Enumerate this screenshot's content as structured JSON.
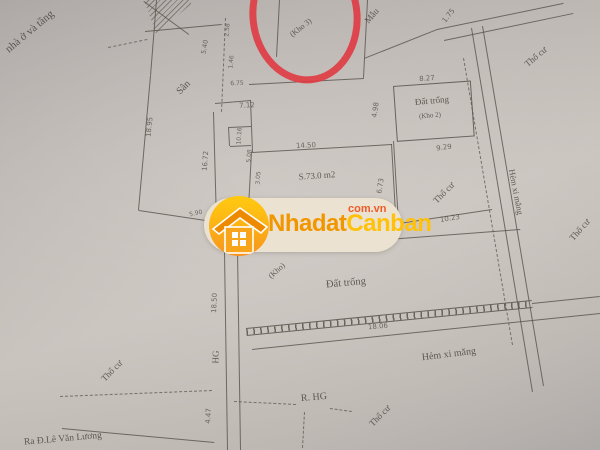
{
  "colors": {
    "ink": "#57514b",
    "paper": "#bcb6b1",
    "highlight": "#e03a42",
    "logo_yellow": "#ffc10a",
    "logo_orange": "#f29600",
    "logo_red": "#ef5a28",
    "logo_bg": "#ece2d1"
  },
  "logo": {
    "brand_part1": "Nhadat",
    "brand_part2": "Canban",
    "domain_suffix": "com.vn"
  },
  "labels": [
    {
      "name": "note-top-left",
      "text": "nhà ở và tầng",
      "x": 30,
      "y": 32,
      "rot": -40,
      "size": 11,
      "font": "serif"
    },
    {
      "name": "san-label",
      "text": "Sân",
      "x": 184,
      "y": 88,
      "rot": -45,
      "size": 10,
      "font": "serif"
    },
    {
      "name": "mau-label",
      "text": "Mẫu",
      "x": 372,
      "y": 16,
      "rot": -50,
      "size": 9,
      "font": "serif"
    },
    {
      "name": "kho3-label",
      "text": "(Kho 3)",
      "x": 301,
      "y": 28,
      "rot": -38,
      "size": 8,
      "font": "serif"
    },
    {
      "name": "thocu-top-right",
      "text": "Thổ cư",
      "x": 536,
      "y": 57,
      "rot": -40,
      "size": 9,
      "font": "serif"
    },
    {
      "name": "dattrong-kho2-label",
      "text": "Đất trống",
      "x": 432,
      "y": 101,
      "rot": -5,
      "size": 9,
      "font": "serif"
    },
    {
      "name": "kho2-label",
      "text": "(Kho 2)",
      "x": 430,
      "y": 116,
      "rot": -5,
      "size": 7,
      "font": "serif"
    },
    {
      "name": "area-label",
      "text": "S.73.0 m2",
      "x": 317,
      "y": 176,
      "rot": -4,
      "size": 9,
      "font": "serif"
    },
    {
      "name": "thocu-middle",
      "text": "Thổ cư",
      "x": 444,
      "y": 193,
      "rot": -45,
      "size": 9,
      "font": "serif"
    },
    {
      "name": "hem-xi-mang-right",
      "text": "Hẻm xi măng",
      "x": 516,
      "y": 192,
      "rot": 79,
      "size": 8.5,
      "font": "serif"
    },
    {
      "name": "thocu-far-right",
      "text": "Thổ cư",
      "x": 580,
      "y": 230,
      "rot": -48,
      "size": 9,
      "font": "serif"
    },
    {
      "name": "dattrong-bottom-label",
      "text": "Đất trống",
      "x": 346,
      "y": 284,
      "rot": -5,
      "size": 10.5,
      "font": "serif"
    },
    {
      "name": "kho-bottom-label",
      "text": "(Kho)",
      "x": 277,
      "y": 271,
      "rot": -42,
      "size": 8,
      "font": "serif"
    },
    {
      "name": "thocu-bottom-left",
      "text": "Thổ cư",
      "x": 112,
      "y": 371,
      "rot": -45,
      "size": 9,
      "font": "serif"
    },
    {
      "name": "thocu-bottom-mid",
      "text": "Thổ cư",
      "x": 380,
      "y": 416,
      "rot": -45,
      "size": 9,
      "font": "serif"
    },
    {
      "name": "hem-xi-mang-bottom",
      "text": "Hẻm xi măng",
      "x": 449,
      "y": 355,
      "rot": -7,
      "size": 10,
      "font": "serif"
    },
    {
      "name": "r-hg-label",
      "text": "R. HG",
      "x": 314,
      "y": 398,
      "rot": -5,
      "size": 10,
      "font": "serif"
    },
    {
      "name": "hg-label",
      "text": "HG",
      "x": 216,
      "y": 357,
      "rot": -88,
      "size": 9,
      "font": "serif"
    },
    {
      "name": "ra-le-van-luong-label",
      "text": "Ra Đ.Lê Văn Lương",
      "x": 63,
      "y": 440,
      "rot": -5,
      "size": 9.5,
      "font": "serif"
    },
    {
      "name": "dim-18-95",
      "text": "18.95",
      "x": 150,
      "y": 127,
      "rot": -84,
      "size": 7,
      "font": "sans"
    },
    {
      "name": "dim-16-72",
      "text": "16.72",
      "x": 206,
      "y": 161,
      "rot": -86,
      "size": 7,
      "font": "sans"
    },
    {
      "name": "dim-7-12",
      "text": "7.12",
      "x": 247,
      "y": 106,
      "rot": -3,
      "size": 7,
      "font": "sans"
    },
    {
      "name": "dim-5-40",
      "text": "5.40",
      "x": 205,
      "y": 47,
      "rot": -80,
      "size": 6.5,
      "font": "sans"
    },
    {
      "name": "dim-2-58",
      "text": "2.58",
      "x": 228,
      "y": 30,
      "rot": -85,
      "size": 6,
      "font": "sans"
    },
    {
      "name": "dim-1-46",
      "text": "1.46",
      "x": 232,
      "y": 62,
      "rot": -85,
      "size": 6,
      "font": "sans"
    },
    {
      "name": "dim-6-75",
      "text": "6.75",
      "x": 237,
      "y": 84,
      "rot": -2,
      "size": 6,
      "font": "sans"
    },
    {
      "name": "dim-10-16",
      "text": "10.16",
      "x": 240,
      "y": 136,
      "rot": -86,
      "size": 6,
      "font": "sans"
    },
    {
      "name": "dim-5-08",
      "text": "5.08",
      "x": 250,
      "y": 156,
      "rot": -86,
      "size": 6,
      "font": "sans"
    },
    {
      "name": "dim-3-05",
      "text": "3.05",
      "x": 259,
      "y": 178,
      "rot": -86,
      "size": 6,
      "font": "sans"
    },
    {
      "name": "dim-5-90",
      "text": "5.90",
      "x": 196,
      "y": 214,
      "rot": -12,
      "size": 6,
      "font": "sans"
    },
    {
      "name": "dim-14-50",
      "text": "14.50",
      "x": 306,
      "y": 146,
      "rot": -3,
      "size": 7,
      "font": "sans"
    },
    {
      "name": "dim-6-73",
      "text": "6.73",
      "x": 381,
      "y": 186,
      "rot": -82,
      "size": 7,
      "font": "sans"
    },
    {
      "name": "dim-4-98",
      "text": "4.98",
      "x": 376,
      "y": 110,
      "rot": -82,
      "size": 7,
      "font": "sans"
    },
    {
      "name": "dim-8-27",
      "text": "8.27",
      "x": 427,
      "y": 79,
      "rot": -5,
      "size": 7,
      "font": "sans"
    },
    {
      "name": "dim-9-29",
      "text": "9.29",
      "x": 444,
      "y": 148,
      "rot": -7,
      "size": 7,
      "font": "sans"
    },
    {
      "name": "dim-10-23",
      "text": "10.23",
      "x": 450,
      "y": 219,
      "rot": -9,
      "size": 7,
      "font": "sans"
    },
    {
      "name": "dim-1-75",
      "text": "1.75",
      "x": 449,
      "y": 16,
      "rot": -52,
      "size": 7,
      "font": "sans"
    },
    {
      "name": "dim-18-06",
      "text": "18.06",
      "x": 378,
      "y": 327,
      "rot": -5,
      "size": 7,
      "font": "sans"
    },
    {
      "name": "dim-18-50",
      "text": "18.50",
      "x": 215,
      "y": 303,
      "rot": -87,
      "size": 7,
      "font": "sans"
    },
    {
      "name": "dim-4-47",
      "text": "4.47",
      "x": 209,
      "y": 416,
      "rot": -87,
      "size": 7,
      "font": "sans"
    }
  ]
}
